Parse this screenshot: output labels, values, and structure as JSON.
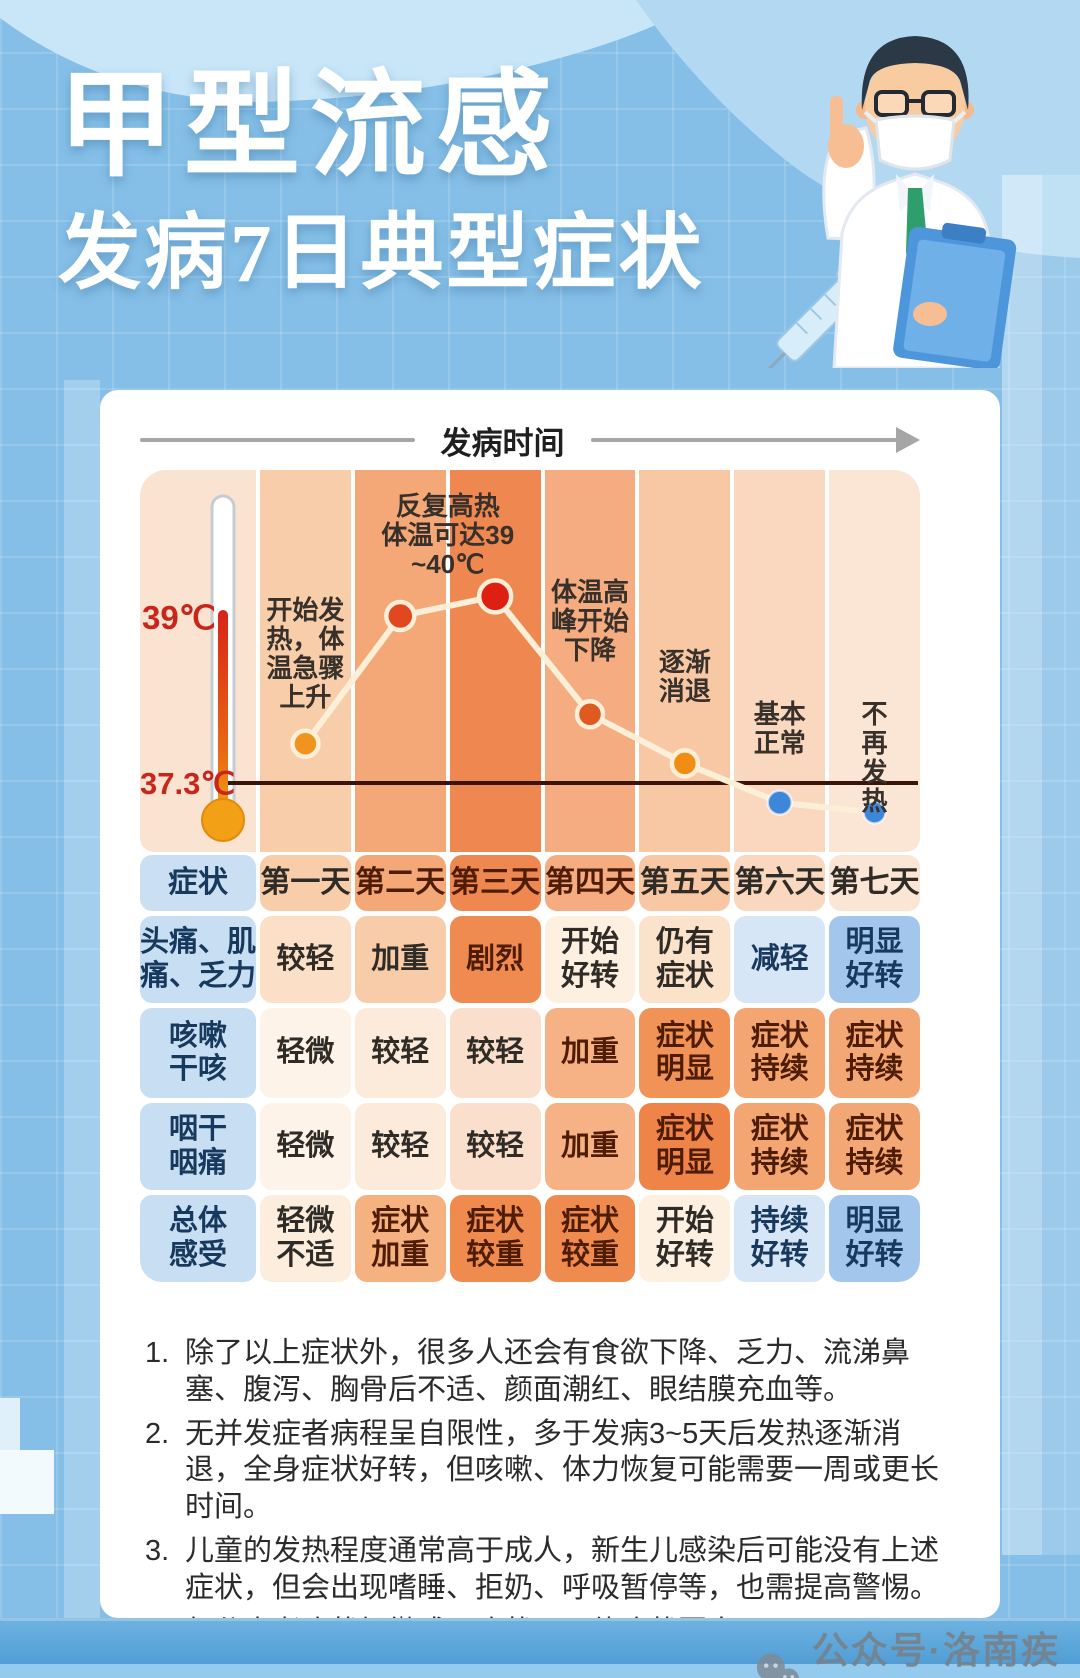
{
  "title": {
    "line1": "甲型流感",
    "line2": "发病7日典型症状"
  },
  "timeline": {
    "label": "发病时间"
  },
  "thermometer": {
    "high_label": "39℃",
    "low_label": "37.3℃"
  },
  "chart_data": {
    "type": "line",
    "title": "发病时间",
    "categories": [
      "第一天",
      "第二天",
      "第三天",
      "第四天",
      "第五天",
      "第六天",
      "第七天"
    ],
    "series": [
      {
        "name": "体温(℃)",
        "values": [
          37.7,
          39.0,
          39.2,
          38.0,
          37.5,
          37.1,
          37.0
        ]
      }
    ],
    "ylabel": "体温",
    "reference_levels": {
      "high": {
        "label": "39℃",
        "value": 39
      },
      "normal": {
        "label": "37.3℃",
        "value": 37.3
      }
    },
    "annotations": [
      {
        "day": 1,
        "text": "开始发\n热，体\n温急骤\n上升"
      },
      {
        "day": 2.5,
        "text": "反复高热\n体温可达39\n~40℃"
      },
      {
        "day": 4,
        "text": "体温高\n峰开始\n下降"
      },
      {
        "day": 5,
        "text": "逐渐\n消退"
      },
      {
        "day": 6,
        "text": "基本\n正常"
      },
      {
        "day": 7,
        "text": "不再\n发热"
      }
    ],
    "line_color": "#FBEFD7",
    "reference_line_color": "#3a140a",
    "point_colors": [
      "#F0931F",
      "#E2481F",
      "#DD2012",
      "#DE5A20",
      "#F08D12",
      "#3E86D8",
      "#3E86D8"
    ],
    "point_radii": [
      13,
      14,
      16,
      13,
      13,
      12,
      11
    ],
    "thermo_band_color": "#FAE3D1",
    "band_colors": [
      "#F8CDA9",
      "#F4A877",
      "#EE8850",
      "#F5AC80",
      "#F8C8A4",
      "#FAD8BF",
      "#FBE5D5"
    ]
  },
  "table": {
    "header": [
      "症状",
      "第一天",
      "第二天",
      "第三天",
      "第四天",
      "第五天",
      "第六天",
      "第七天"
    ],
    "header_label_bg": "#CBDFF2",
    "label_bg": "#C8DEF2",
    "rows": [
      {
        "label": "头痛、肌\n痛、乏力",
        "cells": [
          {
            "text": "较轻",
            "bg": "#FBE0C7"
          },
          {
            "text": "加重",
            "bg": "#F8CCA8"
          },
          {
            "text": "剧烈",
            "bg": "#EF8B51"
          },
          {
            "text": "开始\n好转",
            "bg": "#FDF0E1"
          },
          {
            "text": "仍有\n症状",
            "bg": "#FBE2CB"
          },
          {
            "text": "减轻",
            "bg": "#D6E6F6"
          },
          {
            "text": "明显\n好转",
            "bg": "#A3C6EC"
          }
        ]
      },
      {
        "label": "咳嗽\n干咳",
        "cells": [
          {
            "text": "轻微",
            "bg": "#FEF3E8"
          },
          {
            "text": "较轻",
            "bg": "#FCEBDB"
          },
          {
            "text": "较轻",
            "bg": "#FAE0CC"
          },
          {
            "text": "加重",
            "bg": "#F6B285"
          },
          {
            "text": "症状\n明显",
            "bg": "#F19257"
          },
          {
            "text": "症状\n持续",
            "bg": "#F3A572"
          },
          {
            "text": "症状\n持续",
            "bg": "#F3A775"
          }
        ]
      },
      {
        "label": "咽干\n咽痛",
        "cells": [
          {
            "text": "轻微",
            "bg": "#FEF3E8"
          },
          {
            "text": "较轻",
            "bg": "#FCEBDB"
          },
          {
            "text": "较轻",
            "bg": "#FAE0CC"
          },
          {
            "text": "加重",
            "bg": "#F6B285"
          },
          {
            "text": "症状\n明显",
            "bg": "#EF8449"
          },
          {
            "text": "症状\n持续",
            "bg": "#F3A572"
          },
          {
            "text": "症状\n持续",
            "bg": "#F3A775"
          }
        ]
      },
      {
        "label": "总体\n感受",
        "cells": [
          {
            "text": "轻微\n不适",
            "bg": "#FCEDDC"
          },
          {
            "text": "症状\n加重",
            "bg": "#F6B181"
          },
          {
            "text": "症状\n较重",
            "bg": "#F08B4F"
          },
          {
            "text": "症状\n较重",
            "bg": "#F08B4F"
          },
          {
            "text": "开始\n好转",
            "bg": "#FDF0E1"
          },
          {
            "text": "持续\n好转",
            "bg": "#D6E6F6"
          },
          {
            "text": "明显\n好转",
            "bg": "#A3C6EC"
          }
        ]
      }
    ]
  },
  "notes": [
    {
      "num": "1.",
      "text": "除了以上症状外，很多人还会有食欲下降、乏力、流涕鼻塞、腹泻、胸骨后不适、颜面潮红、眼结膜充血等。"
    },
    {
      "num": "2.",
      "text": "无并发症者病程呈自限性，多于发病3~5天后发热逐渐消退，全身症状好转，但咳嗽、体力恢复可能需要一周或更长时间。"
    },
    {
      "num": "3.",
      "text": "儿童的发热程度通常高于成人，新生儿感染后可能没有上述症状，但会出现嗜睡、拒奶、呼吸暂停等，也需提高警惕。"
    },
    {
      "num": "4.",
      "text": "部分患者症状轻微或无症状，具体症状因人而异。"
    }
  ],
  "watermark": {
    "icon": "wechat-icon",
    "text": "公众号·洛南疾控"
  }
}
